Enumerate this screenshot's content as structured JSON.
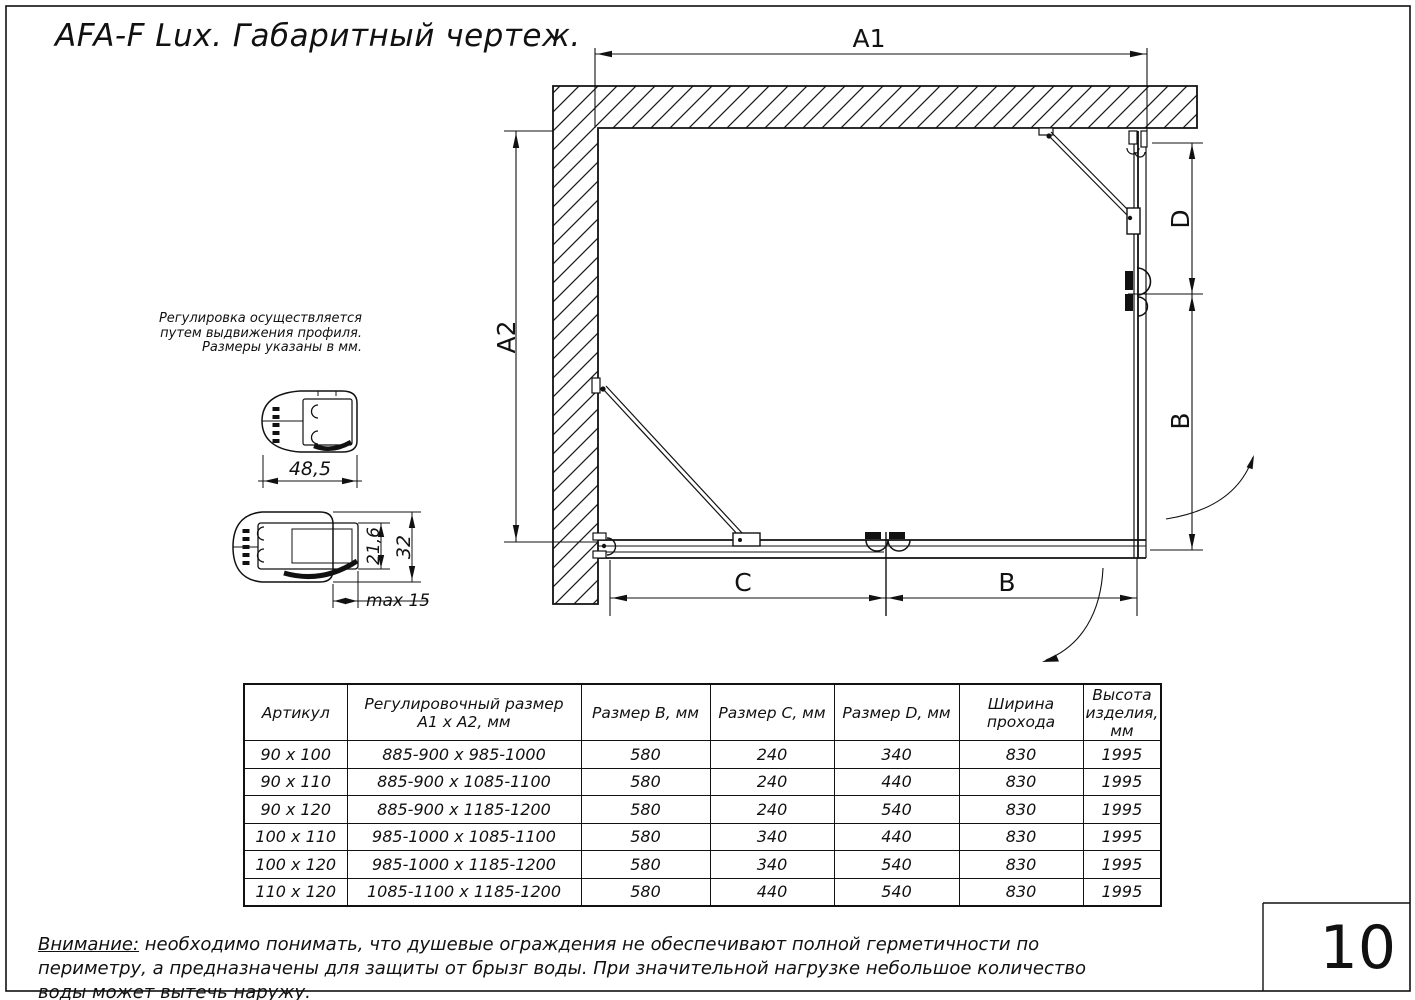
{
  "title": "AFA-F Lux. Габаритный чертеж.",
  "page_number": "10",
  "drawing": {
    "dim_labels": {
      "a1": "A1",
      "a2": "A2",
      "d_right": "D",
      "b_right": "B",
      "c_bottom": "C",
      "b_bottom": "B"
    }
  },
  "profiles": {
    "note_line1": "Регулировка осуществляется",
    "note_line2": "путем выдвижения профиля.",
    "note_line3": "Размеры указаны в мм.",
    "width_dim": "48,5",
    "inner_height_dim": "21,6",
    "outer_height_dim": "32",
    "extension_dim": "max 15"
  },
  "table": {
    "headers": [
      "Артикул",
      "Регулировочный размер\nА1 x А2, мм",
      "Размер В, мм",
      "Размер С, мм",
      "Размер D, мм",
      "Ширина\nпрохода",
      "Высота\nизделия,\nмм"
    ],
    "rows": [
      [
        "90 x 100",
        "885-900 x 985-1000",
        "580",
        "240",
        "340",
        "830",
        "1995"
      ],
      [
        "90 x 110",
        "885-900 x 1085-1100",
        "580",
        "240",
        "440",
        "830",
        "1995"
      ],
      [
        "90 x 120",
        "885-900 x 1185-1200",
        "580",
        "240",
        "540",
        "830",
        "1995"
      ],
      [
        "100 x 110",
        "985-1000 x 1085-1100",
        "580",
        "340",
        "440",
        "830",
        "1995"
      ],
      [
        "100 x 120",
        "985-1000 x 1185-1200",
        "580",
        "340",
        "540",
        "830",
        "1995"
      ],
      [
        "110 x 120",
        "1085-1100 x 1185-1200",
        "580",
        "440",
        "540",
        "830",
        "1995"
      ]
    ]
  },
  "footer": {
    "warning_label": "Внимание:",
    "warning_text": " необходимо понимать, что душевые ограждения не обеспечивают полной герметичности по периметру, а предназначены для защиты от брызг воды. При значительной нагрузке небольшое количество воды может вытечь наружу."
  }
}
